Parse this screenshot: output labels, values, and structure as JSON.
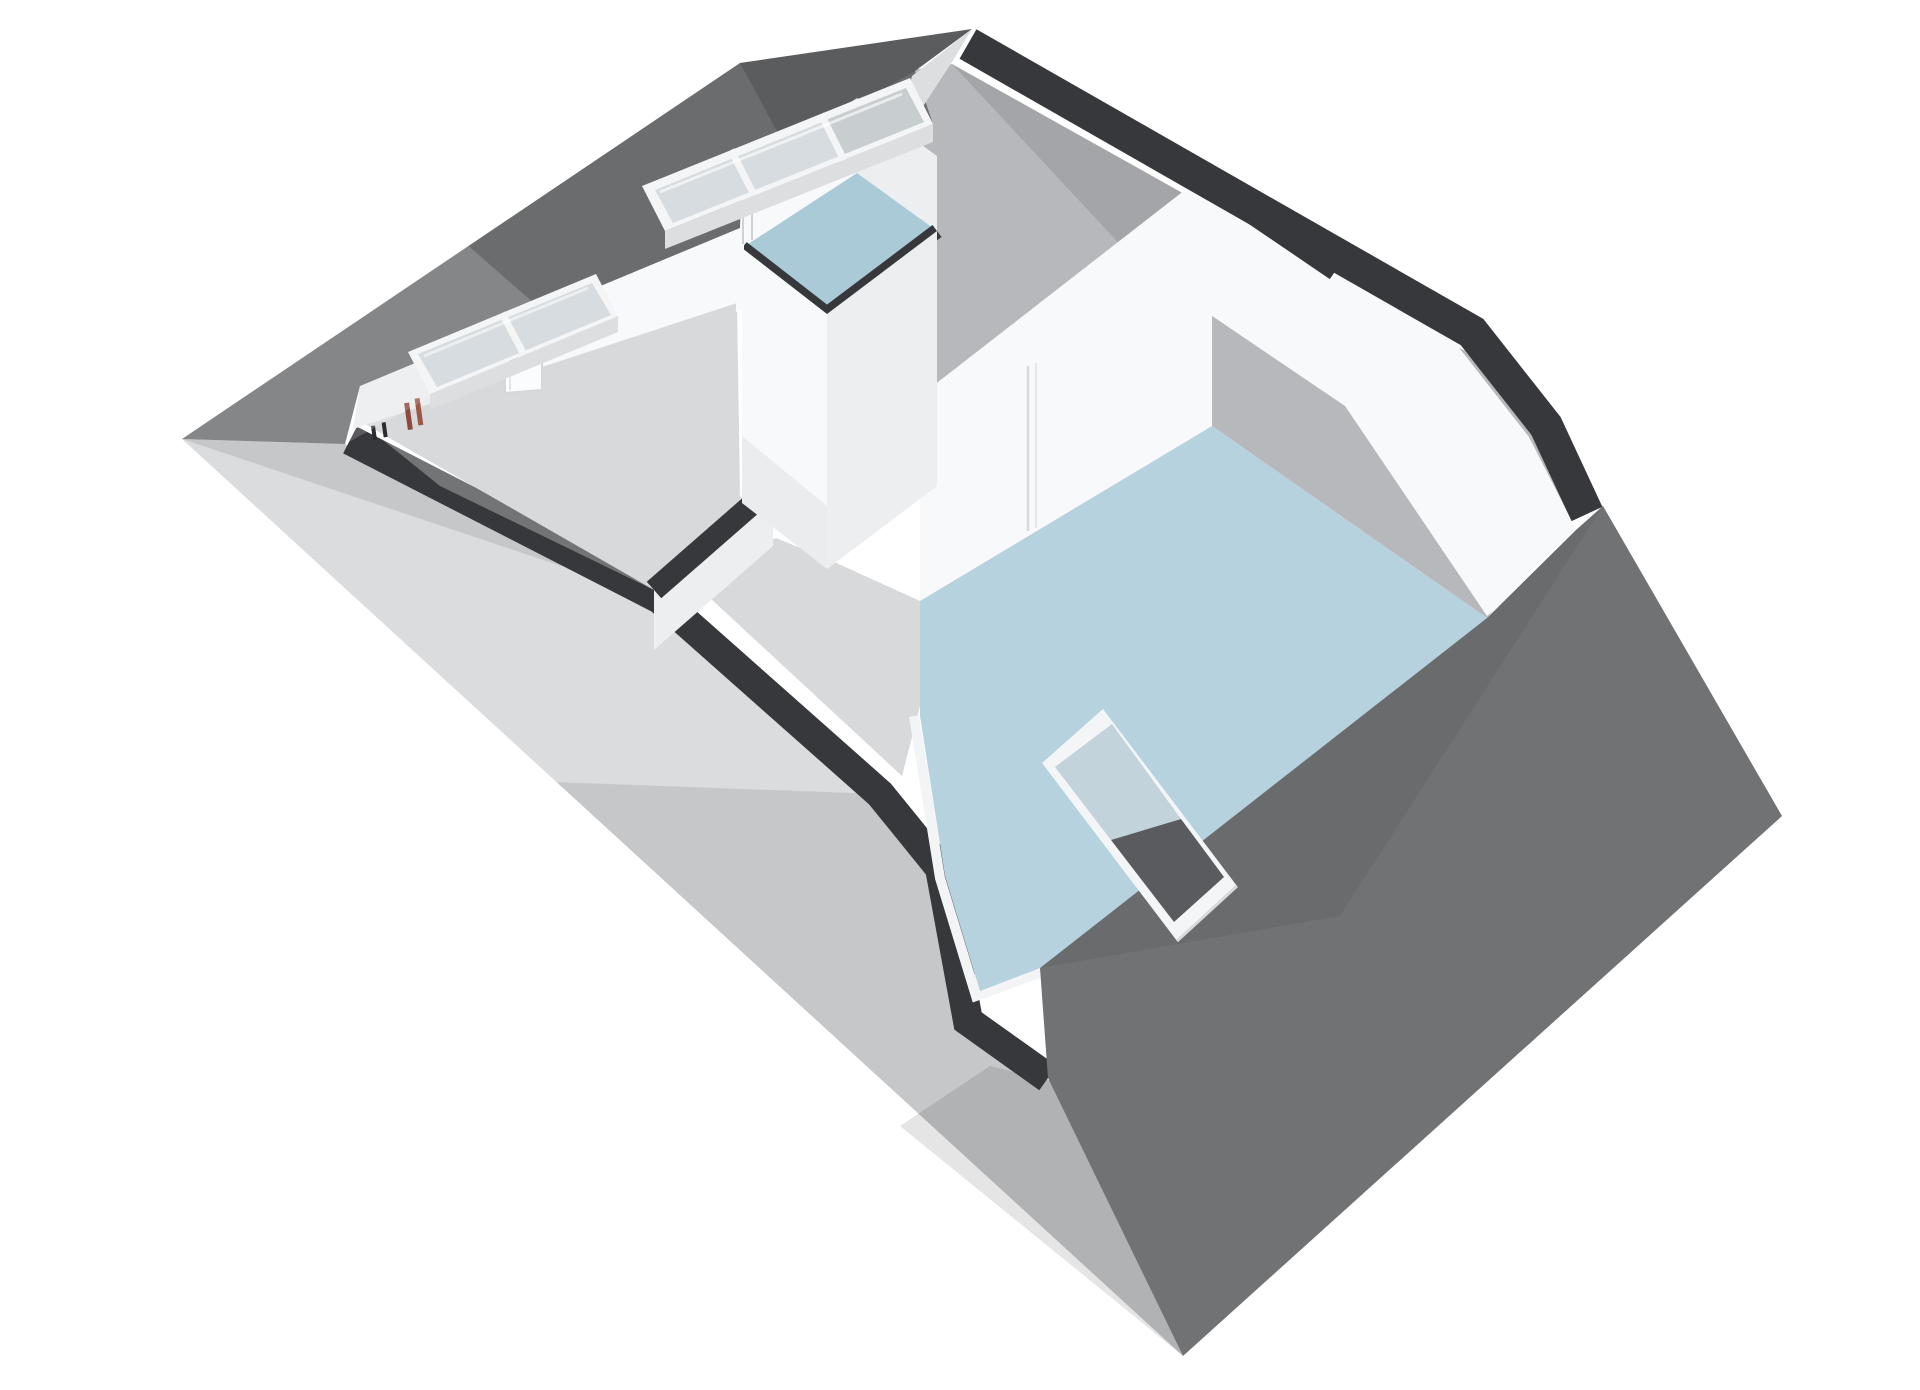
{
  "scene": {
    "type": "3d-floorplan-cutaway",
    "view": "isometric-birds-eye",
    "description": "3D cutaway floor plan of an attic level with sloped roof planes, two roof skylights, a gray-floored room with door and radiator pipes, a small blue-floored bathroom, a central chimney/stair block, a large blue-floored room with a floor-level roof window frame",
    "rooms": [
      {
        "id": "room-left",
        "floor_finish": "gray",
        "features": [
          "two-pane-skylight",
          "door-with-handle",
          "radiator-pipes"
        ]
      },
      {
        "id": "room-bath-small",
        "floor_finish": "blue",
        "features": [
          "three-pane-skylight"
        ]
      },
      {
        "id": "landing-hall",
        "floor_finish": "gray",
        "features": [
          "chimney-block"
        ]
      },
      {
        "id": "room-right-large",
        "floor_finish": "blue",
        "features": [
          "door",
          "floor-level-roof-window"
        ]
      }
    ],
    "skylights": [
      {
        "id": "skylight-three-pane",
        "panes": 3,
        "location": "upper-roof-over-bathroom"
      },
      {
        "id": "skylight-two-pane",
        "panes": 2,
        "location": "upper-roof-over-left-room"
      }
    ],
    "roof_window": {
      "id": "floor-roof-window",
      "location": "right-room-floor-to-roof-slope"
    }
  },
  "colors": {
    "background": "#ffffff",
    "roof_left": "#6a6c6e",
    "roof_right": "#707274",
    "roof_edge_band": "#37383c",
    "slope_interior": "#b7b8bb",
    "exterior_wall": "#c6c7c9",
    "wall_bright": "#f7f9fa",
    "wall_light": "#eceeef",
    "wall_shaded": "#dcdee0",
    "floor_gray": "#d8d9db",
    "floor_blue": "#b6d2df",
    "floor_blue_small": "#abcad8",
    "glass": "#d6dcdf",
    "frame_white": "#f3f5f6",
    "window_glass_dark": "#5a5b5e",
    "pipe_red": "#8d4a3c",
    "pipe_red_light": "#9b5748",
    "pipe_dark": "#2b2c2e"
  }
}
